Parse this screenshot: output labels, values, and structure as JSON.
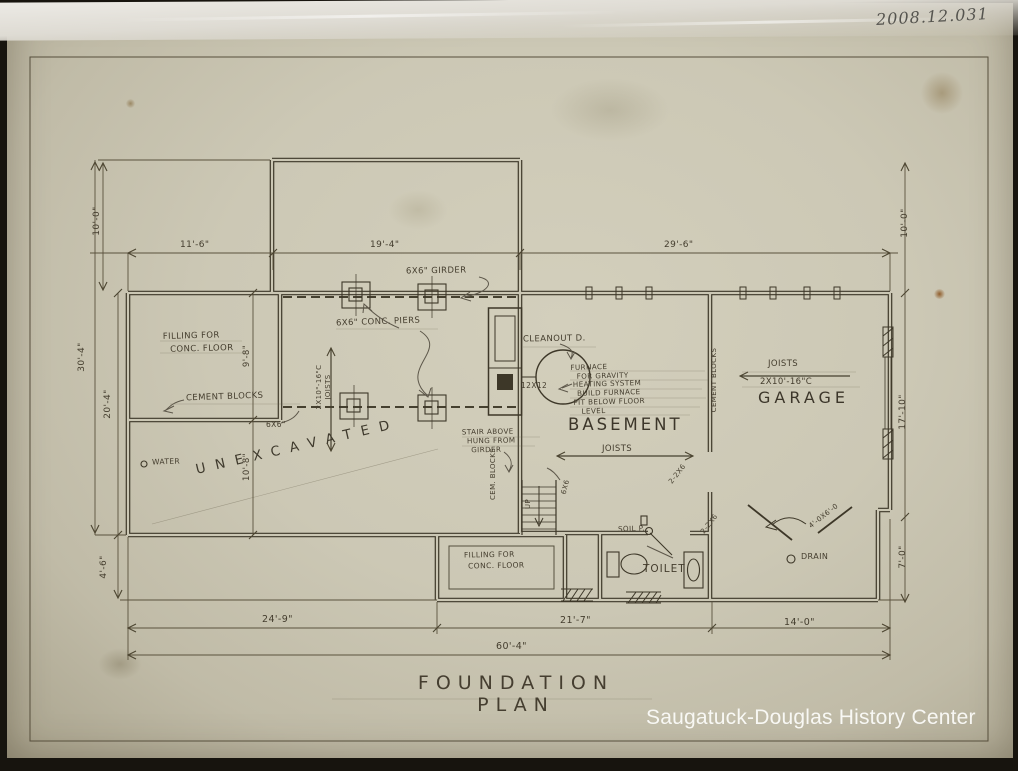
{
  "photo": {
    "accession": "2008.12.031",
    "watermark": "Saugatuck-Douglas History Center"
  },
  "title": "FOUNDATION PLAN",
  "rooms": {
    "unexcavated": "UNEXCAVATED",
    "basement": "BASEMENT",
    "garage": "GARAGE",
    "toilet": "TOILET"
  },
  "dims": {
    "top": [
      "11'-6\"",
      "19'-4\"",
      "29'-6\""
    ],
    "left_10": "10'-0\"",
    "left_30": "30'-4\"",
    "left_20": "20'-4\"",
    "left_4": "4'-6\"",
    "right_10": "10'-0\"",
    "right_17": "17'-10\"",
    "right_7": "7'-0\"",
    "inner_9": "9'-8\"",
    "inner_10": "10'-8\"",
    "bottom_24": "24'-9\"",
    "bottom_21": "21'-7\"",
    "bottom_14": "14'-0\"",
    "bottom_60": "60'-4\""
  },
  "notes": {
    "filling_1": "FILLING FOR",
    "filling_2": "CONC. FLOOR",
    "cement_blocks": "CEMENT BLOCKS",
    "block_6x6": "6X6\"",
    "water": "WATER",
    "girder": "6X6\" GIRDER",
    "conc_piers": "6X6\" CONC. PIERS",
    "joists_left_size": "2X10\"-16\"C",
    "joists_left_word": "JOISTS",
    "cleanout": "CLEANOUT D.",
    "flue": "12X12",
    "furnace": [
      "FURNACE",
      "FOR GRAVITY",
      "HEATING SYSTEM",
      "BUILD FURNACE",
      "PIT BELOW FLOOR",
      "LEVEL"
    ],
    "stair": [
      "STAIR ABOVE",
      "HUNG FROM",
      "GIRDER"
    ],
    "cem_blocks": "CEM. BLOCKS",
    "up": "UP",
    "post": "6X6",
    "joists": "JOISTS",
    "garage_joists": "JOISTS",
    "garage_joists_size": "2X10'-16\"C",
    "garage_cement_blocks": "CEMENT BLOCKS",
    "soil": "SOIL P.",
    "header_a": "2-2X6",
    "header_b": "2-2X6",
    "drain": "DRAIN",
    "door": "4'-0X6'-0",
    "filling_b1": "FILLING FOR",
    "filling_b2": "CONC. FLOOR"
  }
}
